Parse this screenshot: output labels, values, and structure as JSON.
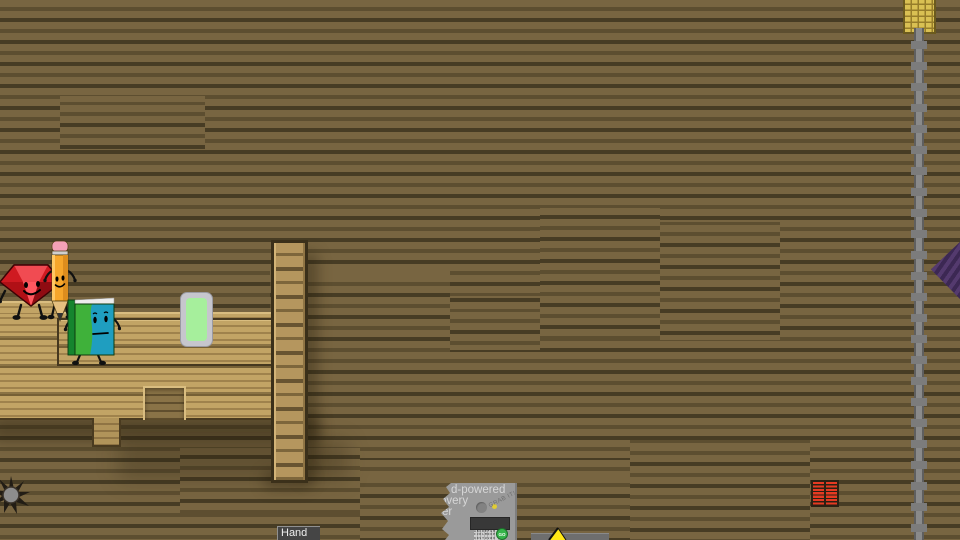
{
  "scene": {
    "description": "Side-view wooden-plank platformer room with object-show characters",
    "background_color": "#786541",
    "platform_wood_color": "#c2a465"
  },
  "characters": {
    "ruby": {
      "name": "ruby-gem-character",
      "body_color": "#e4222a"
    },
    "pencil": {
      "name": "pencil-character",
      "body_color": "#f6a62b",
      "eraser_color": "#f4a0b6"
    },
    "book": {
      "name": "book-character",
      "cover_green": "#3fb13a",
      "cover_teal": "#1f9ec0"
    }
  },
  "hprc_machine": {
    "title_lines": [
      "d-powered",
      "overy",
      "er"
    ],
    "scribble_text": "GRAB IT!",
    "keypad_rows": [
      "ABCDEFGH",
      "IJKLMNOP",
      "QRSTUVWX",
      "YZ"
    ],
    "go_button_label": "GO",
    "body_color": "#9a9a9a",
    "screen_color": "#383838",
    "go_button_color": "#35b44a"
  },
  "sign": {
    "label": "Hand",
    "bg_color": "#454545",
    "text_color": "#eeeeee"
  },
  "props": {
    "respawn_pad": {
      "frame_color": "#c6c6cd",
      "glow_color": "#a6ef9c"
    },
    "basket": {
      "color": "#d9c053"
    },
    "pole": {
      "color": "#8a8a8a"
    },
    "pennant_flag": {
      "color": "#4a3163"
    },
    "vent": {
      "bar_color": "#e63a22"
    },
    "sun_emblem": {
      "spike_color": "#221d15",
      "center_color": "#8d8d8d"
    },
    "yellow_wedge": {
      "color": "#ffe715"
    }
  }
}
